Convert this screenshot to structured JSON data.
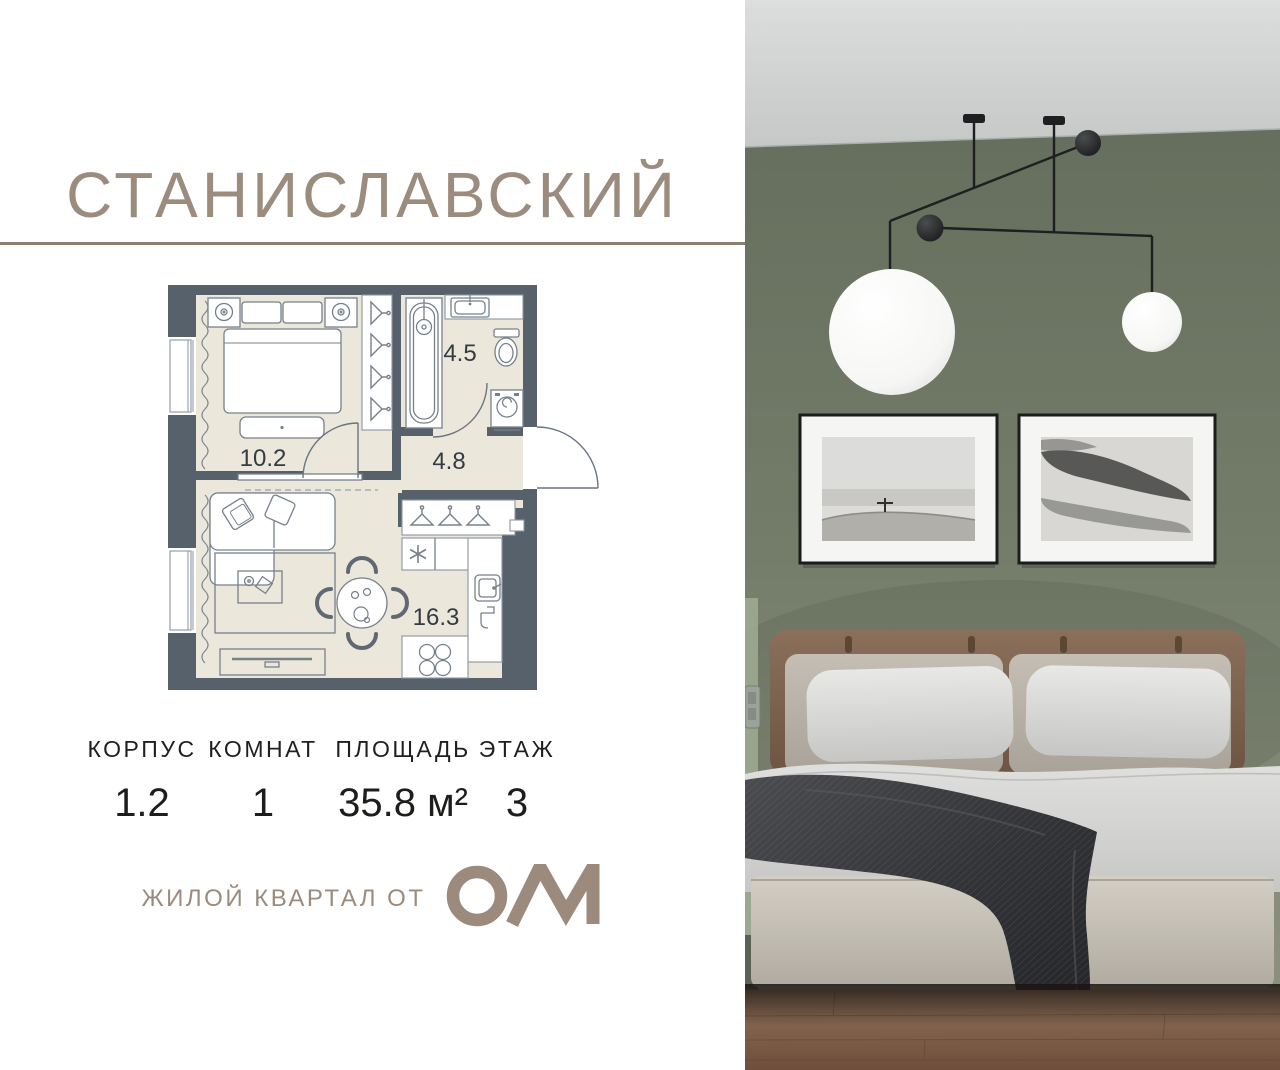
{
  "header": {
    "title": "СТАНИСЛАВСКИЙ",
    "accent_color": "#9c8c7e"
  },
  "floor_plan": {
    "areas": {
      "bedroom": "10.2",
      "bathroom": "4.5",
      "hallway": "4.8",
      "living_kitchen": "16.3"
    },
    "colors": {
      "walls": "#57616c",
      "floor": "#ebe7db",
      "lines": "#77818c",
      "labels": "#333b43"
    }
  },
  "specs": {
    "korpus": {
      "label": "КОРПУС",
      "value": "1.2"
    },
    "komnat": {
      "label": "КОМНАТ",
      "value": "1"
    },
    "ploshchad": {
      "label": "ПЛОЩАДЬ",
      "value": "35.8 м²"
    },
    "etazh": {
      "label": "ЭТАЖ",
      "value": "3"
    }
  },
  "footer": {
    "tagline": "ЖИЛОЙ КВАРТАЛ ОТ",
    "brand": "ОМ"
  },
  "photo_palette": {
    "ceiling": "#d2d5d3",
    "wall": "#747c6a",
    "frame_mat": "#f5f5f3",
    "headboard": "#7b624f",
    "cushions": "#b8b2a8",
    "bedding": "#d6d6d4",
    "throw": "#35363a",
    "bed_base": "#c6c1b7",
    "floor": "#82624b"
  }
}
